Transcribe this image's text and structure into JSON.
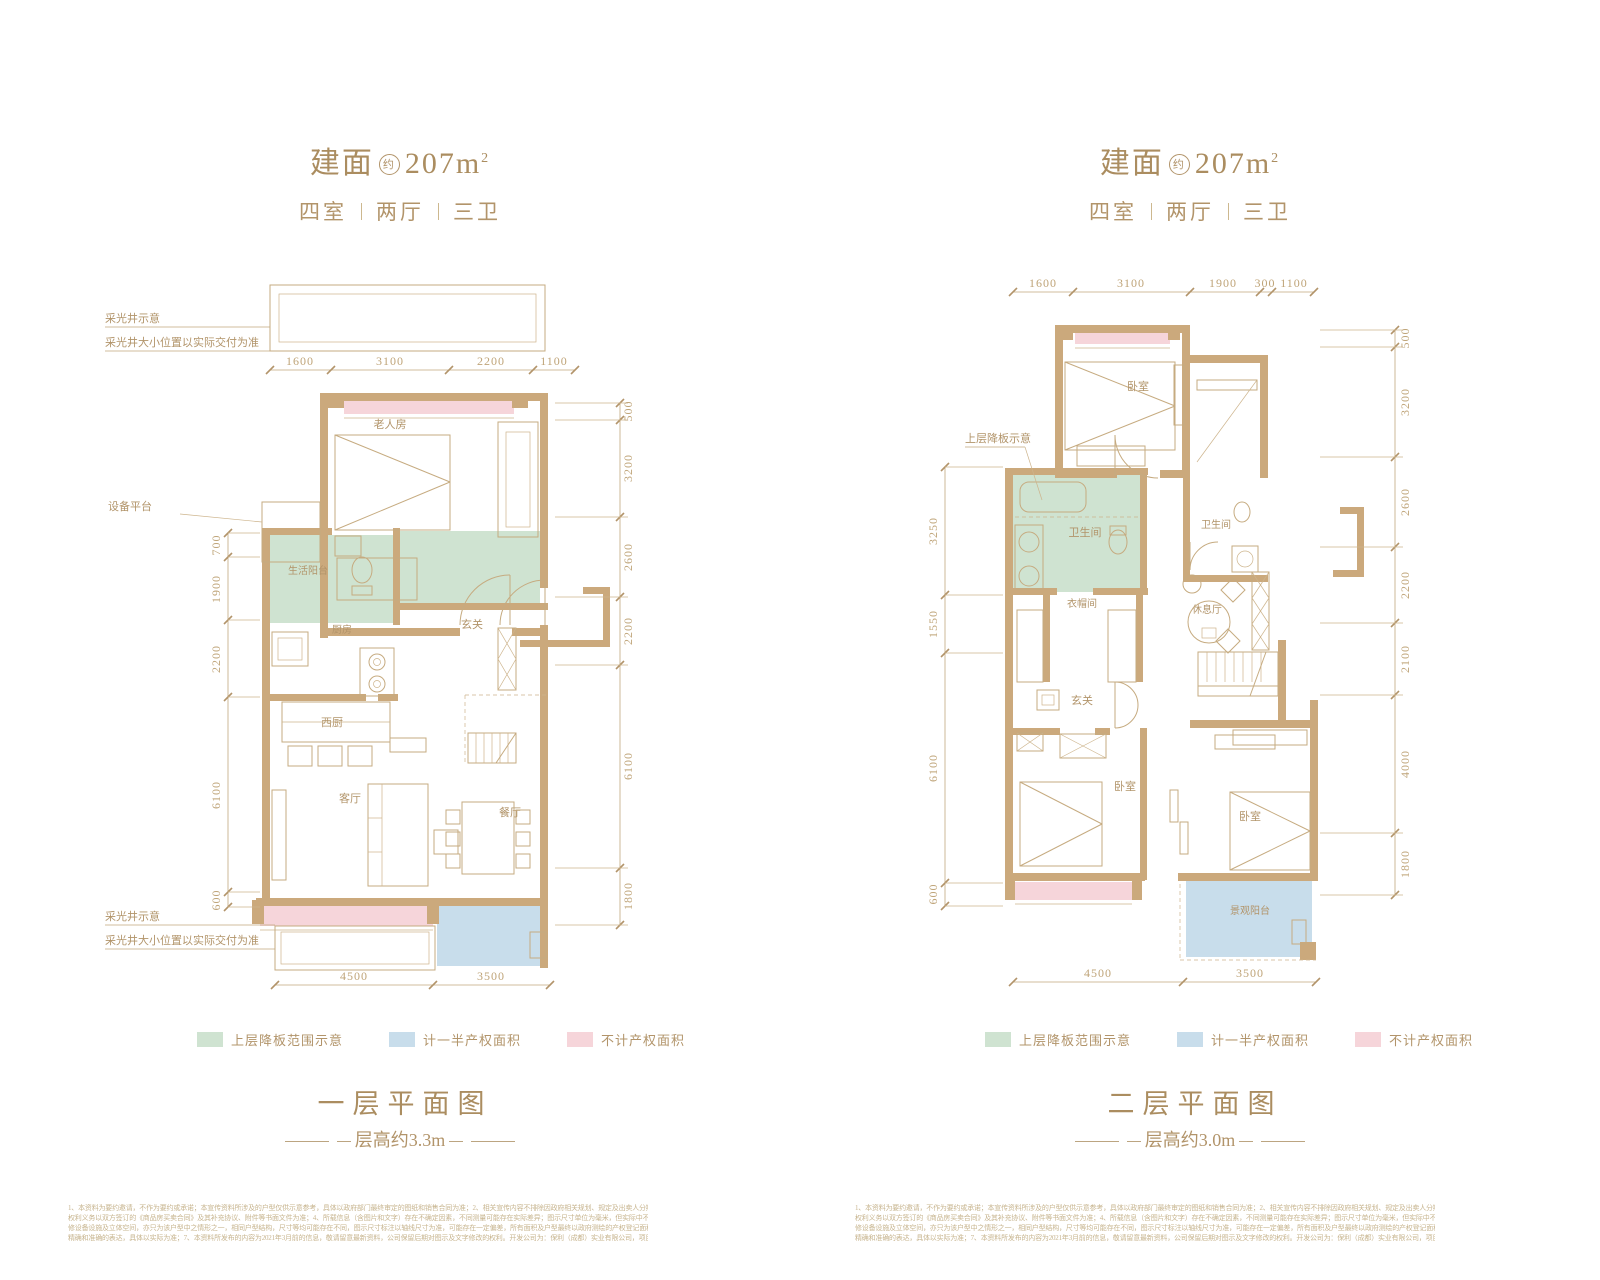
{
  "header": {
    "area_prefix": "建面",
    "area_approx": "约",
    "area_value": "207m",
    "area_sup": "2",
    "layout_parts": [
      "四室",
      "两厅",
      "三卫"
    ]
  },
  "legend": {
    "items": [
      {
        "label": "上层降板范围示意",
        "color": "#cfe3d1"
      },
      {
        "label": "计一半产权面积",
        "color": "#c8ddeb"
      },
      {
        "label": "不计产权面积",
        "color": "#f6d5da"
      }
    ]
  },
  "plans": [
    {
      "caption": "一层平面图",
      "height_note": "层高约3.3m",
      "lightwell_title": "采光井示意",
      "lightwell_note": "采光井大小位置以实际交付为准",
      "dims_top": [
        "1600",
        "3100",
        "2200",
        "1100"
      ],
      "dims_left": [
        "700",
        "1900",
        "2200",
        "6100",
        "600"
      ],
      "dims_right": [
        "500",
        "3200",
        "2600",
        "2200",
        "6100",
        "1800"
      ],
      "dims_bottom": [
        "4500",
        "3500"
      ],
      "rooms": {
        "elder_room": "老人房",
        "equipment": "设备平台",
        "service_balcony": "生活阳台",
        "kitchen": "厨房",
        "foyer": "玄关",
        "west_kitchen": "西厨",
        "living": "客厅",
        "dining": "餐厅"
      }
    },
    {
      "caption": "二层平面图",
      "height_note": "层高约3.0m",
      "drop_note": "上层降板示意",
      "dims_top": [
        "1600",
        "3100",
        "1900",
        "300",
        "1100"
      ],
      "dims_left": [
        "3250",
        "1550",
        "6100",
        "600"
      ],
      "dims_right": [
        "500",
        "3200",
        "2600",
        "2200",
        "2100",
        "4000",
        "1800"
      ],
      "dims_bottom": [
        "4500",
        "3500"
      ],
      "rooms": {
        "bedroom_top": "卧室",
        "bath_main": "卫生间",
        "bath_second": "卫生间",
        "lounge": "休息厅",
        "cloakroom": "衣帽间",
        "foyer": "玄关",
        "bedroom_left": "卧室",
        "bedroom_right": "卧室",
        "view_balcony": "景观阳台"
      }
    }
  ],
  "disclaimer": {
    "lines": [
      "1、本资料为要约邀请，不作为要约或承诺；本宣传资料所涉及的户型仅供示意参考，具体以政府部门最终审定的图纸和销售合同为准；2、相关宣传内容不排除因政府相关规划、规定及出卖人分期规划、未能控制等原因而发生变化；3、买卖双方的",
      "权利义务以双方签订的《商品房买卖合同》及其补充协议、附件等书面文件为准；4、所载信息（含图片和文字）存在不确定因素，不同测量可能存在实际差异；图示尺寸单位为毫米，但实际中不精确吻合至毫米（已包含装",
      "修设备设施及立体空间，亦只为该户型中之情形之一，相同户型结构，尺寸等均可能存在不同，图示尺寸标注以轴线尺寸为准，可能存在一定偏差，所有面积及户型最终以政府测绘的产权登记面积及交房现状为准；6、为更加",
      "精确和准确的表达，具体以实际为准；7、本资料所发布的内容为2021年3月前的信息，敬请留意最新资料，公司保留后期对图示及文字修改的权利。开发公司为：保利（成都）实业有限公司，项目备案名：保利西宸林语。"
    ]
  }
}
